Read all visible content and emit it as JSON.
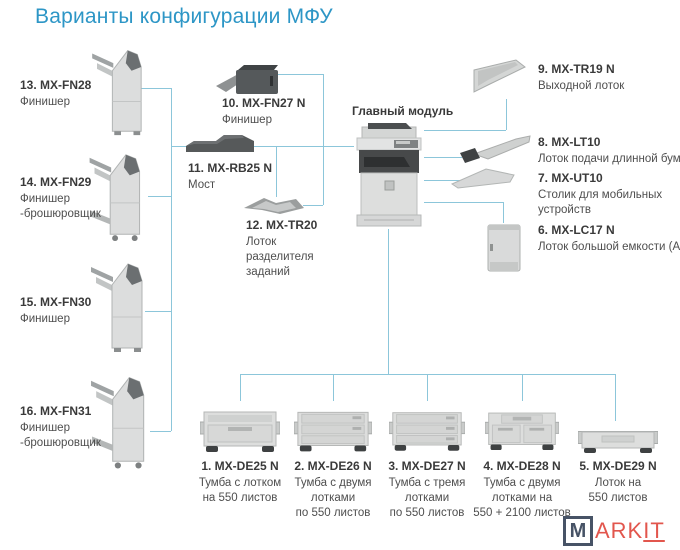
{
  "title": "Варианты конфигурации МФУ",
  "main_module": {
    "label": "Главный модуль"
  },
  "items": {
    "i13": {
      "code": "13. MX-FN28",
      "d1": "Финишер"
    },
    "i14": {
      "code": "14. MX-FN29",
      "d1": "Финишер",
      "d2": "-брошюровщик"
    },
    "i15": {
      "code": "15. MX-FN30",
      "d1": "Финишер"
    },
    "i16": {
      "code": "16. MX-FN31",
      "d1": "Финишер",
      "d2": "-брошюровщик"
    },
    "i10": {
      "code": "10. MX-FN27 N",
      "d1": "Финишер"
    },
    "i11": {
      "code": "11. MX-RB25 N",
      "d1": "Мост"
    },
    "i12": {
      "code": "12. MX-TR20",
      "d1": "Лоток",
      "d2": "разделителя",
      "d3": "заданий"
    },
    "i9": {
      "code": "9. MX-TR19 N",
      "d1": "Выходной лоток"
    },
    "i8": {
      "code": "8. MX-LT10",
      "d1": "Лоток подачи длинной бумаги"
    },
    "i7": {
      "code": "7. MX-UT10",
      "d1": "Столик для мобильных",
      "d2": "устройств"
    },
    "i6": {
      "code": "6. MX-LC17 N",
      "d1": "Лоток большой емкости (А4)"
    },
    "i1": {
      "code": "1. MX-DE25 N",
      "d1": "Тумба с лотком",
      "d2": "на 550 листов"
    },
    "i2": {
      "code": "2. MX-DE26 N",
      "d1": "Тумба с двумя",
      "d2": "лотками",
      "d3": "по 550 листов"
    },
    "i3": {
      "code": "3. MX-DE27 N",
      "d1": "Тумба с тремя",
      "d2": "лотками",
      "d3": "по 550 листов"
    },
    "i4": {
      "code": "4. MX-DE28 N",
      "d1": "Тумба с двумя",
      "d2": "лотками на",
      "d3": "550 + 2100 листов"
    },
    "i5": {
      "code": "5. MX-DE29 N",
      "d1": "Лоток на",
      "d2": "550 листов"
    }
  },
  "watermark": {
    "boxed": "M",
    "text": "ARK",
    "underlined": "IT"
  },
  "colors": {
    "accent_blue": "#2d96c6",
    "line_blue": "#8cc6da",
    "label_dark": "#3a3a3a",
    "label_gray": "#4e4e4e",
    "watermark_navy": "#475366",
    "watermark_red": "#e2564d"
  }
}
